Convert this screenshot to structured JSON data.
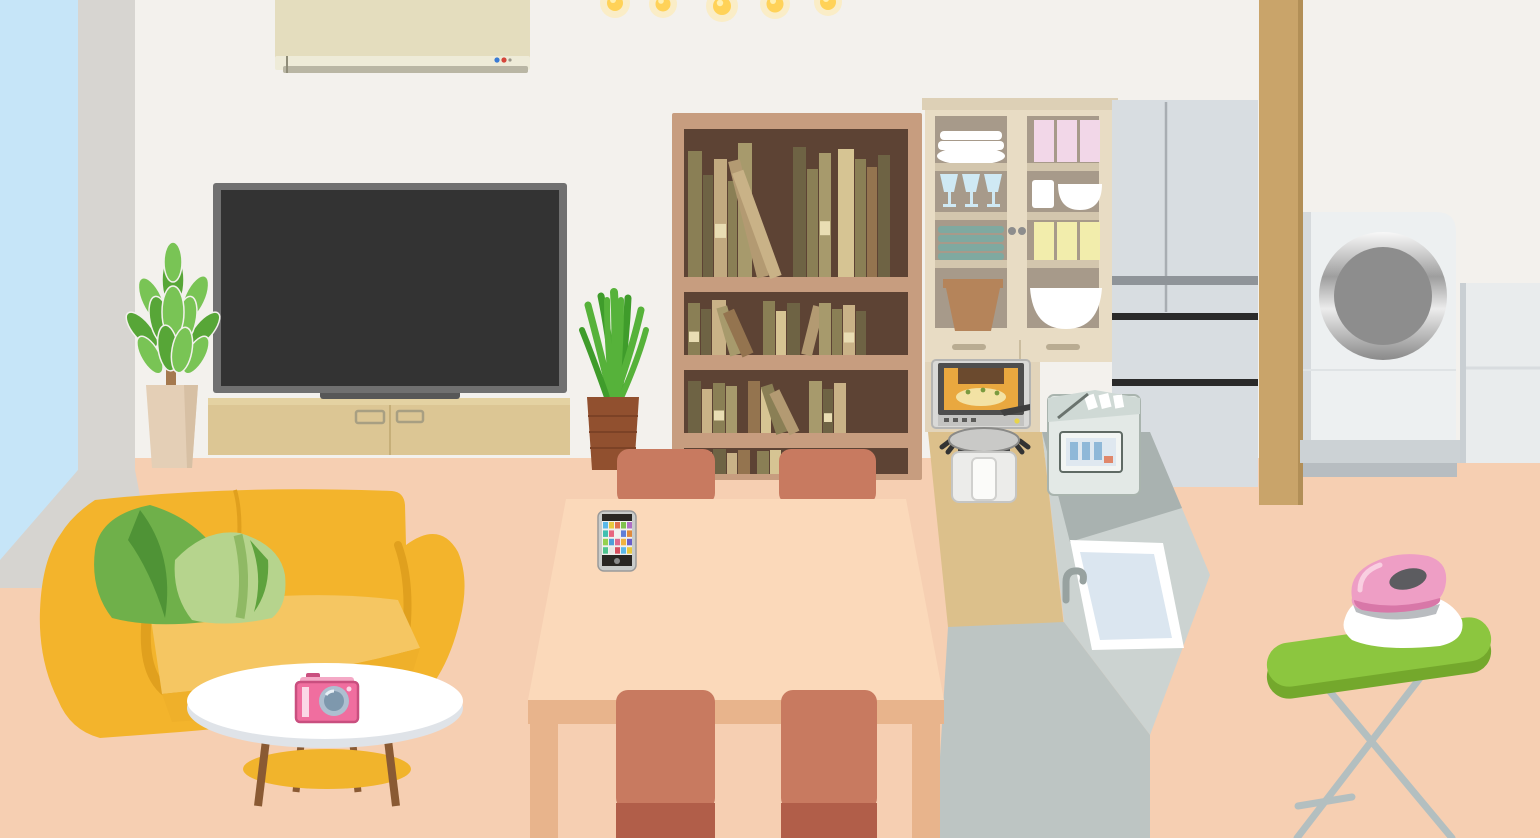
{
  "scene": {
    "description": "flat-illustration of a living room and kitchen with household objects",
    "room": {
      "wall": "#f3f1ed",
      "floor": "#f6cfb2",
      "window_sky": "#c6e5f8",
      "curtain": "#d7d5d1",
      "sill": "#d6d4d0",
      "pillar": "#c9a46a",
      "pillar_edge": "#b28f57"
    },
    "objects": {
      "ceiling_lights": {
        "count": 5,
        "bulb": "#ffd258",
        "glow": "#ffe9a8",
        "highlight": "#fff0b0"
      },
      "air_conditioner": {
        "body": "#e4ddbe",
        "vent": "#eeebd8",
        "louver": "#b9b6a4",
        "led_blue": "#3a7bd5",
        "led_red": "#d5453a"
      },
      "television": {
        "frame": "#707070",
        "screen": "#333333",
        "stand": "#575757"
      },
      "tv_stand": {
        "body": "#dcc694",
        "top": "#e4d2a2",
        "divider": "#c6af79",
        "handle": "#a89f82"
      },
      "plant_left": {
        "pot": "#e4cfb6",
        "pot_shade": "#d7c0a4",
        "trunk": "#a5794e",
        "leaf_dark": "#57a637",
        "leaf_light": "#79c455"
      },
      "plant_right": {
        "pot": "#91502f",
        "ridge": "#7c4226",
        "leaf": "#56b23a",
        "leaf_dark": "#3f9c2b"
      },
      "bookshelf": {
        "frame": "#c79d7f",
        "interior": "#5d4334",
        "label_color": "#e9ddb3",
        "rows": [
          {
            "x": 688,
            "baseline": 277,
            "books": [
              {
                "w": 14,
                "h": 126,
                "c": "#8a7f55"
              },
              {
                "w": 10,
                "h": 102,
                "c": "#6e6344"
              },
              {
                "w": 13,
                "h": 118,
                "c": "#c2aa80",
                "lab": true
              },
              {
                "w": 9,
                "h": 96,
                "c": "#8a7f55"
              },
              {
                "w": 14,
                "h": 134,
                "c": "#a79a6c"
              },
              {
                "gap": 4
              },
              {
                "w": 12,
                "h": 120,
                "c": "#b39a72",
                "t": -14
              },
              {
                "w": 12,
                "h": 112,
                "c": "#c9b287",
                "t": -20
              },
              {
                "gap": 10
              },
              {
                "w": 13,
                "h": 130,
                "c": "#6e6344"
              },
              {
                "w": 11,
                "h": 108,
                "c": "#8a7f55"
              },
              {
                "w": 12,
                "h": 124,
                "c": "#a79a6c",
                "lab": true
              },
              {
                "gap": 6
              },
              {
                "w": 16,
                "h": 128,
                "c": "#d6c493"
              },
              {
                "w": 11,
                "h": 118,
                "c": "#8a7f55"
              },
              {
                "w": 10,
                "h": 110,
                "c": "#94744f"
              },
              {
                "w": 12,
                "h": 122,
                "c": "#6e6344"
              }
            ]
          },
          {
            "x": 688,
            "baseline": 355,
            "books": [
              {
                "w": 12,
                "h": 52,
                "c": "#8a7f55",
                "lab": true
              },
              {
                "w": 10,
                "h": 46,
                "c": "#6e6344"
              },
              {
                "w": 14,
                "h": 55,
                "c": "#c9b287"
              },
              {
                "gap": 3
              },
              {
                "w": 11,
                "h": 50,
                "c": "#a79a6c",
                "t": -16
              },
              {
                "w": 12,
                "h": 48,
                "c": "#94744f",
                "t": -24
              },
              {
                "gap": 8
              },
              {
                "w": 12,
                "h": 54,
                "c": "#8a7f55"
              },
              {
                "w": 10,
                "h": 44,
                "c": "#d6c493"
              },
              {
                "w": 13,
                "h": 52,
                "c": "#6e6344"
              },
              {
                "w": 11,
                "h": 50,
                "c": "#b39a72",
                "t": 14
              },
              {
                "gap": 6
              },
              {
                "w": 12,
                "h": 52,
                "c": "#a79a6c"
              },
              {
                "w": 10,
                "h": 46,
                "c": "#8a7f55"
              },
              {
                "w": 12,
                "h": 50,
                "c": "#c9b287",
                "lab": true
              },
              {
                "w": 10,
                "h": 44,
                "c": "#6e6344"
              }
            ]
          },
          {
            "x": 688,
            "baseline": 433,
            "books": [
              {
                "w": 13,
                "h": 52,
                "c": "#6e6344"
              },
              {
                "w": 10,
                "h": 44,
                "c": "#c9b287"
              },
              {
                "w": 12,
                "h": 50,
                "c": "#8a7f55",
                "lab": true
              },
              {
                "w": 11,
                "h": 47,
                "c": "#a79a6c"
              },
              {
                "gap": 10
              },
              {
                "w": 12,
                "h": 52,
                "c": "#94744f"
              },
              {
                "w": 10,
                "h": 46,
                "c": "#d6c493"
              },
              {
                "gap": 4
              },
              {
                "w": 12,
                "h": 50,
                "c": "#8a7f55",
                "t": -18
              },
              {
                "w": 11,
                "h": 46,
                "c": "#b39a72",
                "t": -26
              },
              {
                "gap": 8
              },
              {
                "w": 13,
                "h": 52,
                "c": "#a79a6c"
              },
              {
                "w": 10,
                "h": 44,
                "c": "#6e6344",
                "lab": true
              },
              {
                "w": 12,
                "h": 50,
                "c": "#c9b287"
              }
            ]
          },
          {
            "x": 688,
            "baseline": 474,
            "books": [
              {
                "w": 12,
                "h": 24,
                "c": "#8a7f55"
              },
              {
                "w": 11,
                "h": 22,
                "c": "#a79a6c"
              },
              {
                "w": 13,
                "h": 25,
                "c": "#6e6344"
              },
              {
                "w": 10,
                "h": 21,
                "c": "#c9b287"
              },
              {
                "w": 12,
                "h": 24,
                "c": "#94744f"
              },
              {
                "gap": 6
              },
              {
                "w": 12,
                "h": 23,
                "c": "#8a7f55"
              },
              {
                "w": 11,
                "h": 24,
                "c": "#d6c493"
              },
              {
                "w": 12,
                "h": 22,
                "c": "#6e6344"
              },
              {
                "w": 10,
                "h": 24,
                "c": "#a79a6c"
              },
              {
                "gap": 5
              },
              {
                "w": 12,
                "h": 23,
                "c": "#b39a72"
              },
              {
                "w": 11,
                "h": 24,
                "c": "#8a7f55"
              },
              {
                "w": 12,
                "h": 22,
                "c": "#c9b287"
              }
            ]
          }
        ]
      },
      "china_cabinet": {
        "frame": "#e8dcc4",
        "top": "#ddd0b6",
        "glass": "#a79a8a",
        "shelf": "#d3c6ad",
        "base": "#e2d4ba",
        "knob": "#8d8d8d",
        "drawer_handle": "#b9ac92",
        "dishes": {
          "plates": "#ffffff",
          "glasses": "#cfe9f4",
          "teal_stack": "#7fa9a0",
          "pot": "#b5845a",
          "pink_cups": "#f2d7e8",
          "yellow_cups": "#f2edac",
          "bowls": "#ffffff"
        }
      },
      "refrigerator": {
        "body": "#d8dde1",
        "handle": "#8f9499",
        "line": "#2a2a2a",
        "seam": "#a8adb2"
      },
      "washing_machine": {
        "body": "#edf0f1",
        "drum": "#8d8d8d",
        "base": "#ccd2d5",
        "base_shadow": "#b7bdc1"
      },
      "laundry_cabinet": {
        "body": "#e9eced",
        "shadow": "#c9cfd3",
        "line": "#d8dcdf"
      },
      "sofa": {
        "body": "#f3b42c",
        "seat": "#f5c662",
        "front": "#efb02a",
        "shade": "#e0a01e"
      },
      "cushion_dark": {
        "body": "#6fb04a",
        "accent": "#4f9336"
      },
      "cushion_light": {
        "body": "#b6d48d",
        "stripe": "#8fb964",
        "fold": "#5ea23d"
      },
      "coffee_table": {
        "top": "#ffffff",
        "rim": "#dfe3e8",
        "shelf": "#f1b42c",
        "legs": "#8a5a33"
      },
      "camera": {
        "body": "#f06e9f",
        "outline": "#c94f7f",
        "top": "#f4a9c6",
        "stripe": "#fbd7e6",
        "lens": "#aebfd0",
        "lens_inner": "#7e98ad"
      },
      "dining_table": {
        "top": "#fbd9ba",
        "apron": "#e8b48c"
      },
      "dining_chairs": {
        "color": "#c87a60",
        "seat": "#b15e49"
      },
      "smartphone": {
        "frame": "#c9cbc9",
        "bezel": "#2a2723",
        "screen": "#f0f0ee",
        "button": "#8a8a8a",
        "icon_colors": [
          [
            "#5bb8e8",
            "#e8c93f",
            "#e0704f",
            "#7fc04f",
            "#b06fc4"
          ],
          [
            "#3fbfb0",
            "#e7657f",
            "#f0f0ee",
            "#5f7fd8",
            "#e08a3c"
          ],
          [
            "#94d14f",
            "#4f9fd8",
            "#e06a8f",
            "#f0b33f",
            "#6a5fc8"
          ],
          [
            "#4fc48f",
            "#e8e8e6",
            "#d84f5f",
            "#5bb8e8",
            "#e8c93f"
          ]
        ]
      },
      "kitchen_counter": {
        "wood": "#dcc08b",
        "top": "#ccd3d1",
        "back": "#a9b2b0",
        "face": "#bdc5c3",
        "sink_rim": "#ffffff",
        "sink": "#dbe6f0",
        "faucet": "#98a2a0"
      },
      "toaster_oven": {
        "body": "#d9d9d7",
        "frame": "#4e4e4e",
        "window": "#e9a83f",
        "food": "#6b4a2e",
        "toast": "#f3e2a4",
        "panel": "#c3c3c1",
        "dot": "#e8d44a"
      },
      "rice_cooker": {
        "lid": "#c9c9c7",
        "band": "#454545",
        "body": "#ececea",
        "handle": "#fbfbf9"
      },
      "dishwasher": {
        "body": "#e3e9e6",
        "lid": "#cfd9d5",
        "panel": "#f2f5f3",
        "screen": "#dfe8f0",
        "bars": "#8fb8d8",
        "accent": "#e0876a",
        "edge": "#9aa5a0"
      },
      "ironing_board": {
        "top": "#8cc63f",
        "side": "#74a82c",
        "legs": "#b3bfc0",
        "cloth": "#ffffff"
      },
      "iron": {
        "body": "#ee9ec5",
        "dark": "#d877a8",
        "handle_hole": "#5c5c60",
        "base": "#b9bcc0",
        "highlight": "#f9cfe1"
      }
    }
  }
}
